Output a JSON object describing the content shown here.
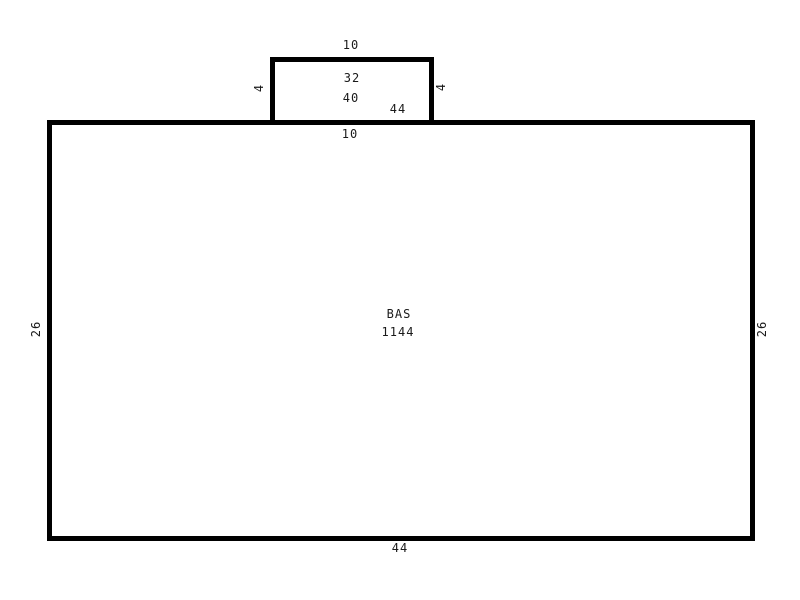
{
  "sketch": {
    "colors": {
      "line": "#000000",
      "background": "#ffffff",
      "text": "#1a1a1a"
    },
    "main_area": {
      "name": "BAS",
      "area_value": "1144",
      "bottom_dim": "44",
      "left_dim": "26",
      "right_dim": "26",
      "top_segment_dim": "10"
    },
    "top_extension": {
      "top_dim": "10",
      "left_dim": "4",
      "right_dim": "4",
      "inner_label_1": "32",
      "inner_label_2": "40",
      "inner_label_3": "44"
    }
  }
}
